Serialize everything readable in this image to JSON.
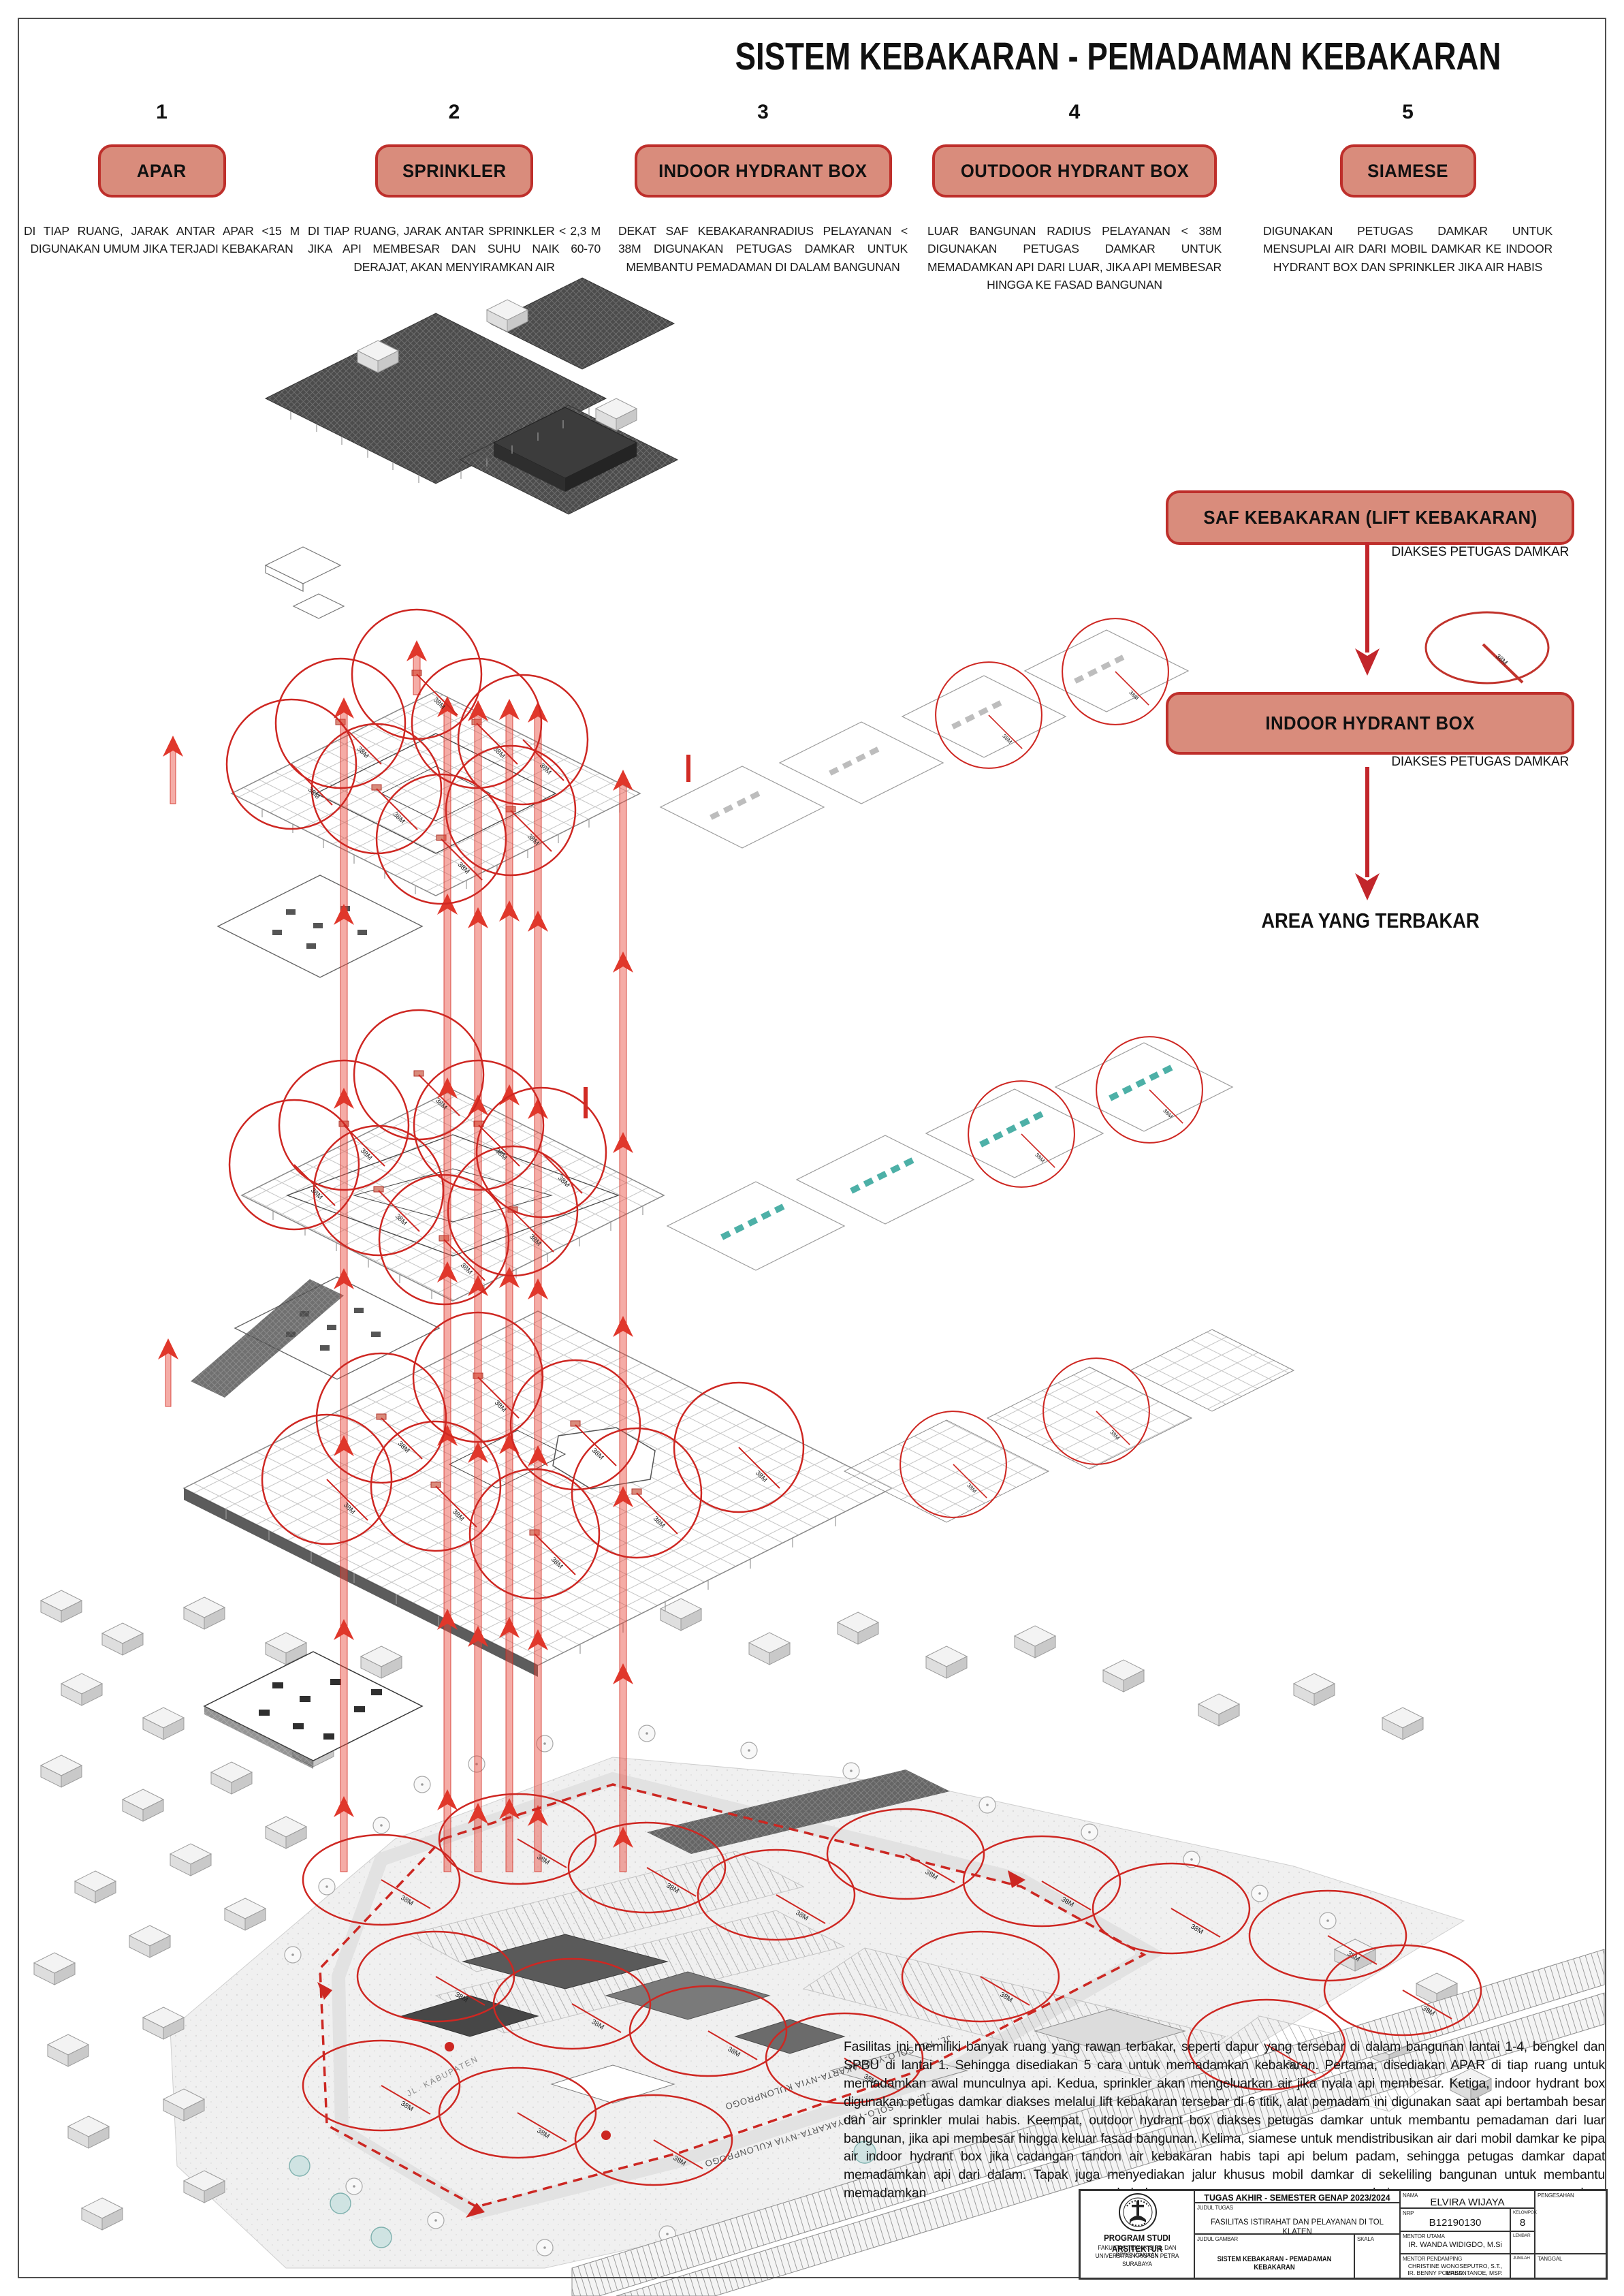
{
  "page": {
    "title": "SISTEM KEBAKARAN - PEMADAMAN KEBAKARAN"
  },
  "methods": [
    {
      "number": "1",
      "label": "APAR",
      "desc": "DI TIAP RUANG, JARAK ANTAR APAR <15 M DIGUNAKAN UMUM JIKA TERJADI KEBAKARAN"
    },
    {
      "number": "2",
      "label": "SPRINKLER",
      "desc": "DI TIAP RUANG, JARAK ANTAR SPRINKLER < 2,3 M JIKA API MEMBESAR DAN SUHU NAIK 60-70 DERAJAT, AKAN MENYIRAMKAN AIR"
    },
    {
      "number": "3",
      "label": "INDOOR HYDRANT BOX",
      "desc": "DEKAT SAF KEBAKARANRADIUS PELAYANAN < 38M DIGUNAKAN PETUGAS DAMKAR UNTUK MEMBANTU PEMADAMAN DI DALAM BANGUNAN"
    },
    {
      "number": "4",
      "label": "OUTDOOR HYDRANT BOX",
      "desc": "LUAR BANGUNAN RADIUS PELAYANAN < 38M DIGUNAKAN PETUGAS DAMKAR UNTUK MEMADAMKAN API DARI LUAR, JIKA API MEMBESAR HINGGA KE FASAD BANGUNAN"
    },
    {
      "number": "5",
      "label": "SIAMESE",
      "desc": "DIGUNAKAN PETUGAS DAMKAR UNTUK MENSUPLAI AIR DARI MOBIL DAMKAR KE INDOOR HYDRANT BOX DAN SPRINKLER JIKA AIR HABIS"
    }
  ],
  "flow": {
    "step1": "SAF KEBAKARAN (LIFT KEBAKARAN)",
    "step1_note": "DIAKSES PETUGAS DAMKAR",
    "step2": "INDOOR HYDRANT BOX",
    "step2_note": "DIAKSES PETUGAS DAMKAR",
    "step3": "AREA YANG TERBAKAR"
  },
  "diagram": {
    "radius_label": "38M",
    "road_label": "JL. TOL SOLO-YOGYAKARTA-NYIA KULONPROGO",
    "street_label": "JL. KABUPATEN"
  },
  "analysis": {
    "paragraph": "Fasilitas ini memiliki banyak ruang yang rawan terbakar, seperti dapur yang tersebar di dalam bangunan lantai 1-4, bengkel dan SPBU di lantai 1. Sehingga disediakan 5 cara untuk memadamkan kebakaran. Pertama, disediakan APAR di tiap ruang untuk memadamkan awal munculnya api. Kedua, sprinkler akan mengeluarkan air jika nyala api membesar. Ketiga, indoor hydrant box digunakan petugas damkar diakses melalui lift kebakaran tersebar di 6 titik, alat pemadam ini digunakan saat api bertambah besar dan air sprinkler mulai habis. Keempat, outdoor hydrant box diakses petugas damkar untuk membantu pemadaman dari luar bangunan, jika api membesar hingga keluar fasad bangunan. Kelima, siamese untuk mendistribusikan air dari mobil damkar ke pipa air indoor hydrant box jika cadangan tandon air kebakaran habis tapi api belum padam, sehingga petugas damkar dapat memadamkan api dari dalam. Tapak juga menyediakan jalur khusus mobil damkar di sekeliling bangunan untuk membantu memadamkan kebakaran dari luar."
  },
  "titleblock": {
    "program": "PROGRAM STUDI ARSITEKTUR",
    "faculty": "FAKULTAS TEKNIK SIPIL DAN PERENCANAAN",
    "university": "UNIVERSITAS KRISTEN PETRA",
    "city": "SURABAYA",
    "header": "TUGAS AKHIR - SEMESTER GENAP 2023/2024",
    "judul_tugas_label": "JUDUL TUGAS",
    "judul_tugas": "FASILITAS ISTIRAHAT DAN PELAYANAN DI TOL KLATEN",
    "judul_gambar_label": "JUDUL GAMBAR",
    "judul_gambar": "SISTEM KEBAKARAN - PEMADAMAN KEBAKARAN",
    "skala_label": "SKALA",
    "nama_label": "NAMA",
    "nama": "ELVIRA WIJAYA",
    "nrp_label": "NRP",
    "nrp": "B12190130",
    "kelompok_label": "KELOMPOK",
    "kelompok": "8",
    "mentor_utama_label": "MENTOR UTAMA",
    "mentor_utama": "IR. WANDA WIDIGDO, M.Si",
    "mentor_pendamping_label": "MENTOR PENDAMPING",
    "mentor_pendamping_1": "CHRISTINE WONOSEPUTRO, S.T., MASD.",
    "mentor_pendamping_2": "IR. BENNY POERBANTANOE, MSP.",
    "lembar_label": "LEMBAR",
    "jumlah_label": "JUMLAH",
    "tanggal_label": "TANGGAL",
    "pengesahan_label": "PENGESAHAN"
  },
  "colors": {
    "accent": "#BE2F2B",
    "box_fill": "#D98C7C",
    "arrow_red": "#E0372B",
    "circle_red": "#CE2722"
  }
}
